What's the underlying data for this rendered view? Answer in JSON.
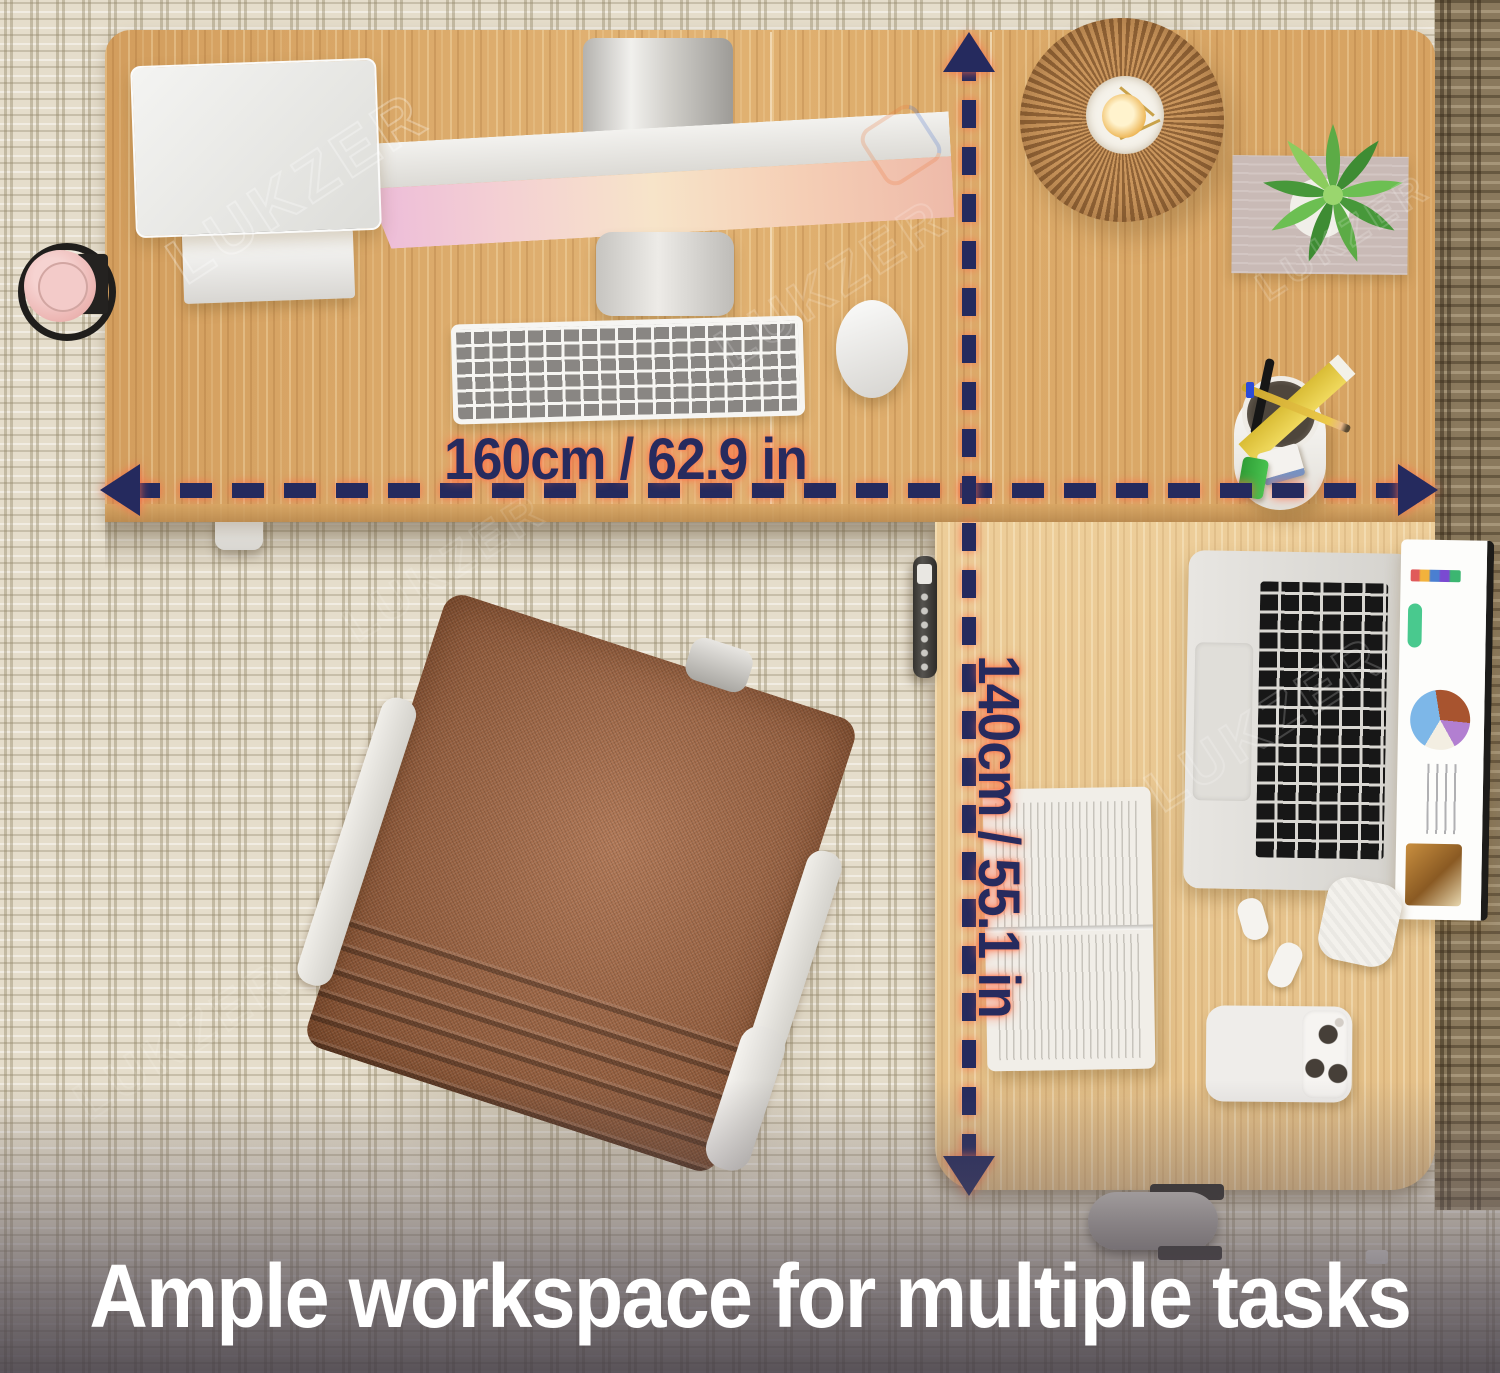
{
  "product_image": {
    "caption": "Ample workspace for multiple tasks",
    "watermark": "LUKZER"
  },
  "dimensions": {
    "width_label": "160cm / 62.9 in",
    "depth_label": "140cm / 55.1 in"
  },
  "scene": {
    "type": "top-down product photo",
    "subject": "L-shaped electric standing desk on carpet",
    "items": [
      "monitor-back",
      "ultrawide-monitor",
      "monitor-stand",
      "keyboard",
      "mouse",
      "pleated-lamp",
      "succulent-plant",
      "magazine",
      "bottle-in-cup-holder",
      "pen-holder",
      "ruler",
      "pencil",
      "pen",
      "eraser",
      "sharpener",
      "height-controller",
      "office-chair",
      "open-book",
      "laptop",
      "earbuds",
      "earbuds-case",
      "phone",
      "caster-wheel",
      "desk-leg"
    ]
  },
  "colors": {
    "arrow_navy": "#252a5e",
    "glow_salmon": "#ff7a5c",
    "wood_top": "#dcaa6a",
    "wood_lower": "#e9c68f",
    "carpet_beige": "#e5ddcb",
    "carpet_dark_strip": "#8a795d",
    "chair_brown": "#a5633c",
    "caption_white": "#ffffff"
  }
}
